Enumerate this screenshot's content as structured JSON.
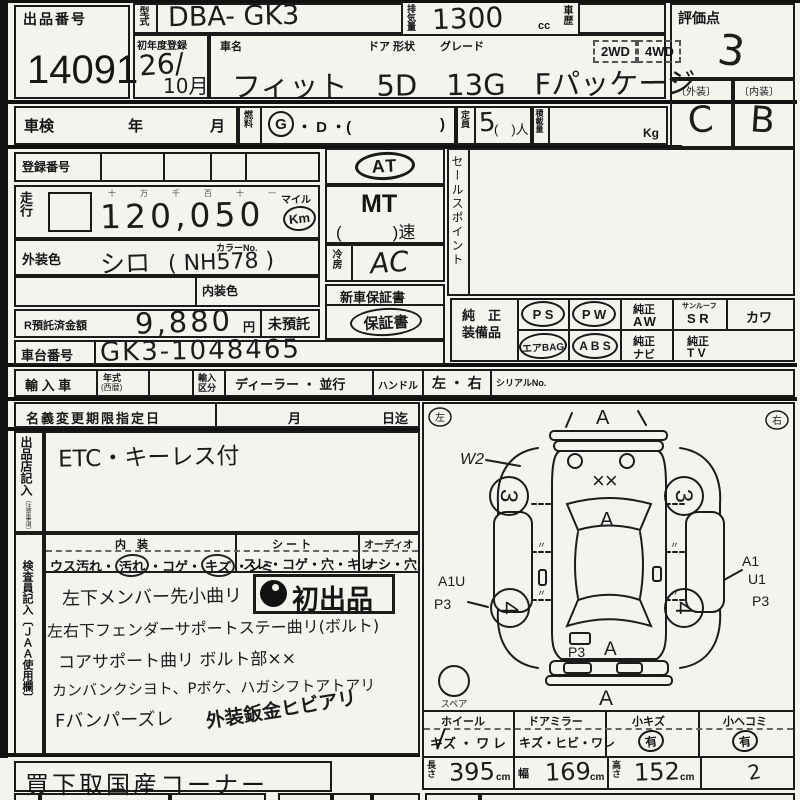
{
  "top": {
    "auction_no_label": "出品番号",
    "auction_no": "14091",
    "model_label": "型式",
    "model": "DBA-  GK3",
    "disp_label": "排気量",
    "disp": "1300",
    "disp_unit": "cc",
    "history_label": "車歴",
    "score_label": "評価点",
    "score": "3",
    "ext_label": "〔外装〕",
    "ext_grade": "C",
    "int_label": "〔内装〕",
    "int_grade": "B",
    "first_reg_label": "初年度登録",
    "first_reg_year": "26/",
    "first_reg_month": "10月",
    "name_label": "車名",
    "door_label": "ドア 形状",
    "grade_label": "グレード",
    "wd2": "2WD",
    "wd4": "4WD",
    "car_name": "フィット　5D　13G　Fパッケージ"
  },
  "row2": {
    "shaken": "車検",
    "year": "年",
    "month": "月",
    "fuel_label": "燃料",
    "fuel_g": "G",
    "fuel_mid": "・ D ・(",
    "fuel_close": ")",
    "cap_label": "定員",
    "cap": "5",
    "cap_suffix": "(　)人",
    "load_label": "積載量",
    "load_unit": "Kg"
  },
  "reg_label": "登録番号",
  "mileage": {
    "label": "走行",
    "guides": "十　万　千　百　十　一",
    "value": "120,050",
    "mile": "マイル",
    "km": "Km"
  },
  "color": {
    "ext_label": "外装色",
    "ext": "シロ",
    "no_label": "カラーNo.",
    "no": "(  NH578  )",
    "int_label": "内装色"
  },
  "trans": {
    "at": "AT",
    "mt": "MT",
    "speed": "(　　　)速",
    "cool_label": "冷房",
    "cool": "AC",
    "warranty_new": "新車保証書",
    "warranty": "保証書"
  },
  "sales_label": "セールスポイント",
  "deposit": {
    "label": "R預託済金額",
    "value": "9,880",
    "yen": "円",
    "none": "未預託"
  },
  "chassis": {
    "label": "車台番号",
    "value": "GK3-1048465"
  },
  "equip": {
    "label1": "純　正",
    "label2": "装備品",
    "ps": "P S",
    "pw": "P W",
    "aw1": "純正",
    "aw2": "AW",
    "sr1": "サンルーフ",
    "sr2": "S R",
    "kawa": "カワ",
    "airbag": "エアBAG",
    "abs": "A B S",
    "navi1": "純正",
    "navi2": "ナビ",
    "tv1": "純正",
    "tv2": "T V"
  },
  "import": {
    "label": "輸 入 車",
    "year1": "年式",
    "year2": "(西暦)",
    "kubun1": "輸入",
    "kubun2": "区分",
    "dealer": "ディーラー ・ 並行",
    "handle": "ハンドル",
    "lr": "左 ・ 右",
    "serial": "シリアルNo."
  },
  "name_change": {
    "label": "名義変更期限指定日",
    "month": "月",
    "until": "日迄"
  },
  "seller": {
    "label": "出品店記入",
    "note": "〔注意事項〕",
    "text": "ETC・キーレス付"
  },
  "cond": {
    "int_header": "内　装",
    "int_pre": "ウス汚れ・",
    "int_soil": "汚れ",
    "int_mid": "・コゲ・",
    "int_kizu": "キズ",
    "int_post": "・シミ",
    "seat_header": "シ ー ト",
    "seat": "スレ・コゲ・穴・キレ",
    "audio_header": "オーディオ",
    "audio": "ナシ・穴"
  },
  "inspector": {
    "label": "検査員記入〔ＪＡＡ使用欄〕",
    "stamp": "初出品",
    "lines": [
      "左下メンバー先小曲リ",
      "左右下フェンダーサポートステー曲リ(ボルト)",
      "コアサポート曲リ ボルト部××",
      "カンバンクシヨト、Pボケ、ハガシフトアトアリ",
      "Fバンパーズレ"
    ],
    "diag": "外装鈑金ヒビアリ"
  },
  "diagram": {
    "left": "左",
    "right": "右",
    "spare": "スペア",
    "a_top": "A",
    "w2": "W2",
    "hood": "××",
    "windshield_a": "A",
    "wheel_fl": "3",
    "wheel_fr": "3",
    "wheel_rl": "4",
    "wheel_rr": "4",
    "left_a1u": "A1U",
    "left_p3": "P3",
    "right_a1": "A1",
    "right_u1": "U1",
    "right_p3": "P3",
    "rear_p3": "P3",
    "rear_a": "A",
    "bottom_a": "A"
  },
  "damage": {
    "wheel_h": "ホイール",
    "wheel_v": "キズ ・ ワ レ",
    "mirror_h": "ドアミラー",
    "mirror_v": "キズ・ヒビ・ワレ",
    "scratch_h": "小キズ",
    "scratch_v": "有",
    "dent_h": "小ヘコミ",
    "dent_v": "有"
  },
  "dims": {
    "len_label": "長さ",
    "len": "395",
    "w_label": "幅",
    "w": "169",
    "h_label": "高さ",
    "h": "152",
    "cm": "cm",
    "note": "2"
  },
  "footer": "買下取国産コーナー"
}
